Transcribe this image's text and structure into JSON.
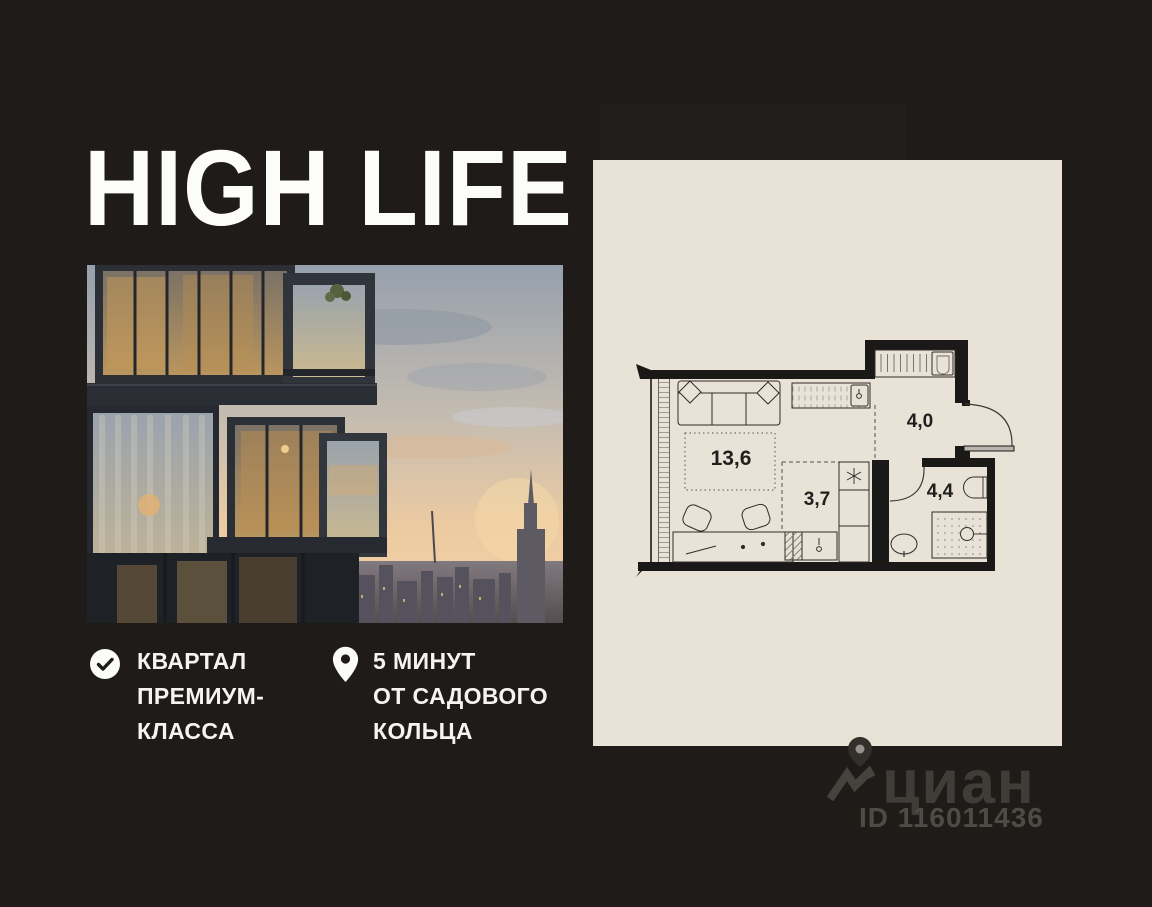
{
  "brand": {
    "logo_text": "HIGH LIFE"
  },
  "features": [
    {
      "icon": "check-circle-icon",
      "lines": [
        "КВАРТАЛ",
        "ПРЕМИУМ-",
        "КЛАССА"
      ]
    },
    {
      "icon": "location-pin-icon",
      "lines": [
        "5 МИНУТ",
        "ОТ САДОВОГО",
        "КОЛЬЦА"
      ]
    }
  ],
  "floor_plan": {
    "type": "studio-apartment-plan",
    "rooms": [
      {
        "name": "living-area",
        "area_m2": "13,6"
      },
      {
        "name": "kitchen-area",
        "area_m2": "3,7"
      },
      {
        "name": "hallway",
        "area_m2": "4,0"
      },
      {
        "name": "bathroom",
        "area_m2": "4,4"
      }
    ]
  },
  "watermark": {
    "brand_text": "циан",
    "listing_id": "ID 116011436"
  },
  "colors": {
    "background": "#1e1b18",
    "panel": "#e9e2d7",
    "text": "#f5f4f2",
    "watermark_gray": "#403d38"
  }
}
